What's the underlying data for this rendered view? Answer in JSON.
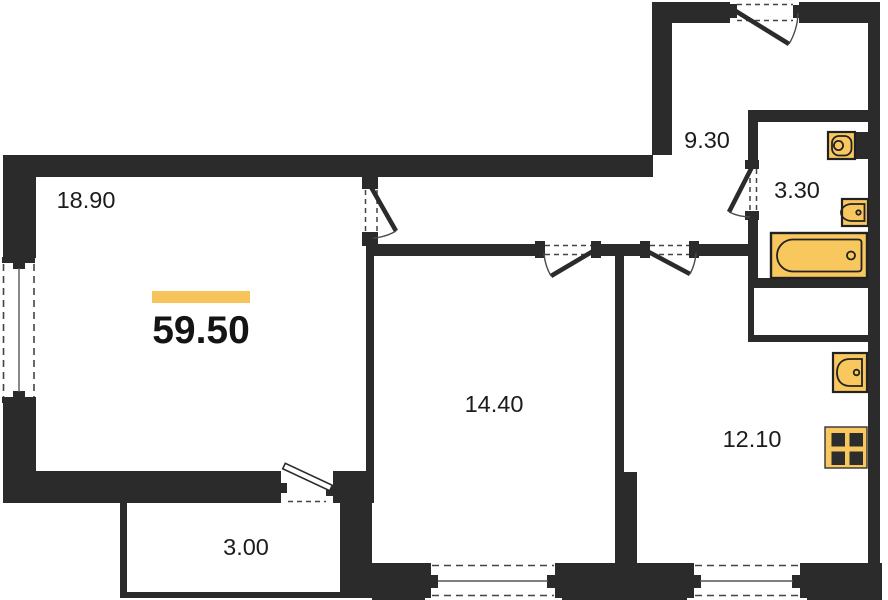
{
  "plan": {
    "type": "apartment-floor-plan",
    "total_area_label": "59.50",
    "rooms": [
      {
        "name": "living-room",
        "area_label": "18.90"
      },
      {
        "name": "hallway",
        "area_label": "9.30"
      },
      {
        "name": "bathroom",
        "area_label": "3.30"
      },
      {
        "name": "bedroom",
        "area_label": "14.40"
      },
      {
        "name": "kitchen",
        "area_label": "12.10"
      },
      {
        "name": "balcony",
        "area_label": "3.00"
      }
    ],
    "fixtures": [
      "washing-machine",
      "washbasin",
      "bathtub",
      "kitchen-sink",
      "stove"
    ],
    "colors": {
      "wall": "#2b2b2b",
      "fixture_fill": "#f8c75e",
      "accent_bar": "#f6c45a",
      "background": "#ffffff"
    }
  }
}
